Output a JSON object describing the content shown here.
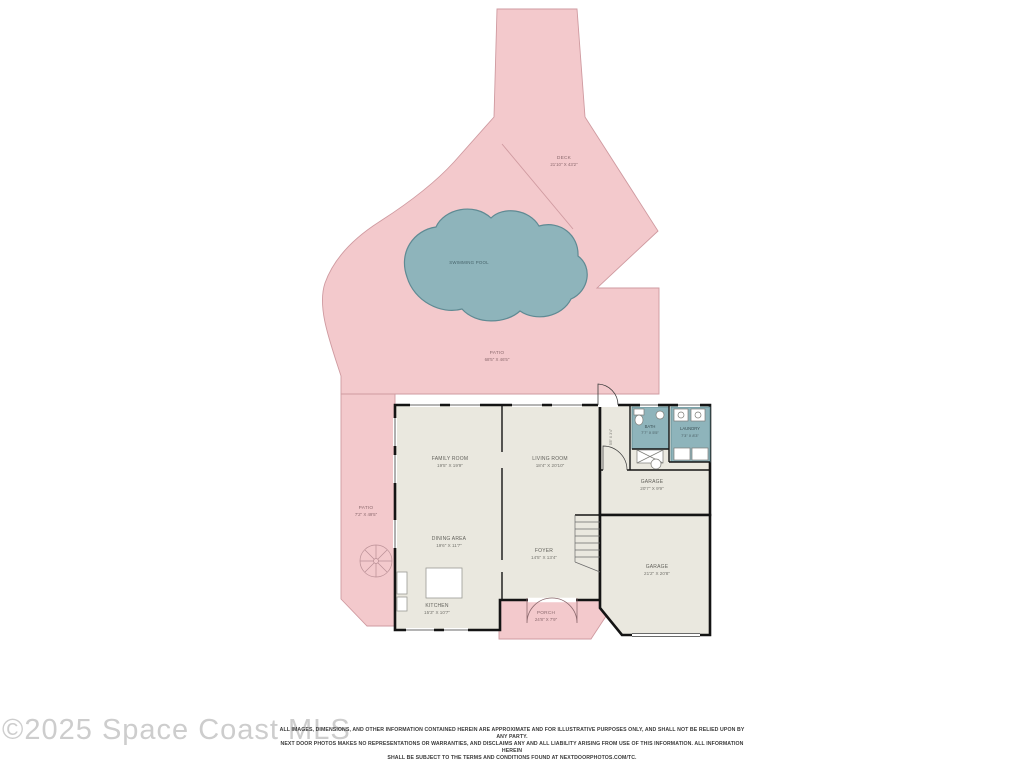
{
  "colors": {
    "patio_pink": "#f3c9cc",
    "pool_teal": "#8eb4bb",
    "floor": "#eae8df",
    "teal_room": "#8eb4bb"
  },
  "areas": {
    "deck": {
      "name": "DECK",
      "dims": "21'10\" X 43'2\""
    },
    "swimming_pool": {
      "name": "SWIMMING POOL"
    },
    "patio_main": {
      "name": "PATIO",
      "dims": "68'5\" X 46'5\""
    },
    "patio_side": {
      "name": "PATIO",
      "dims": "7'2\" X 49'5\""
    },
    "family_room": {
      "name": "FAMILY ROOM",
      "dims": "19'5\" X 19'9\""
    },
    "living_room": {
      "name": "LIVING ROOM",
      "dims": "18'4\" X 20'10\""
    },
    "dining_area": {
      "name": "DINING AREA",
      "dims": "19'6\" X 11'7\""
    },
    "kitchen": {
      "name": "KITCHEN",
      "dims": "15'3\" X 10'7\""
    },
    "foyer": {
      "name": "FOYER",
      "dims": "14'5\" X 13'4\""
    },
    "bath": {
      "name": "BATH",
      "dims": "7'7\" X 5'5\""
    },
    "laundry": {
      "name": "LAUNDRY",
      "dims": "7'3\" X 8'3\""
    },
    "garage_upper": {
      "name": "GARAGE",
      "dims": "20'7\" X 9'9\""
    },
    "garage_main": {
      "name": "GARAGE",
      "dims": "21'2\" X 20'8\""
    },
    "porch": {
      "name": "PORCH",
      "dims": "24'8\" X 7'9\""
    },
    "hall": {
      "dims": "5'8\" X 3'4\""
    }
  },
  "watermark": "©2025 Space Coast MLS",
  "disclaimer": {
    "lines": [
      "ALL IMAGES, DIMENSIONS, AND OTHER INFORMATION CONTAINED HEREIN ARE APPROXIMATE AND FOR ILLUSTRATIVE PURPOSES ONLY, AND SHALL NOT BE RELIED UPON BY ANY PARTY.",
      "NEXT DOOR PHOTOS MAKES NO REPRESENTATIONS OR WARRANTIES, AND DISCLAIMS ANY AND ALL LIABILITY ARISING FROM USE OF THIS INFORMATION. ALL INFORMATION HEREIN",
      "SHALL BE SUBJECT TO THE TERMS AND CONDITIONS FOUND AT NEXTDOORPHOTOS.COM/TC."
    ]
  }
}
